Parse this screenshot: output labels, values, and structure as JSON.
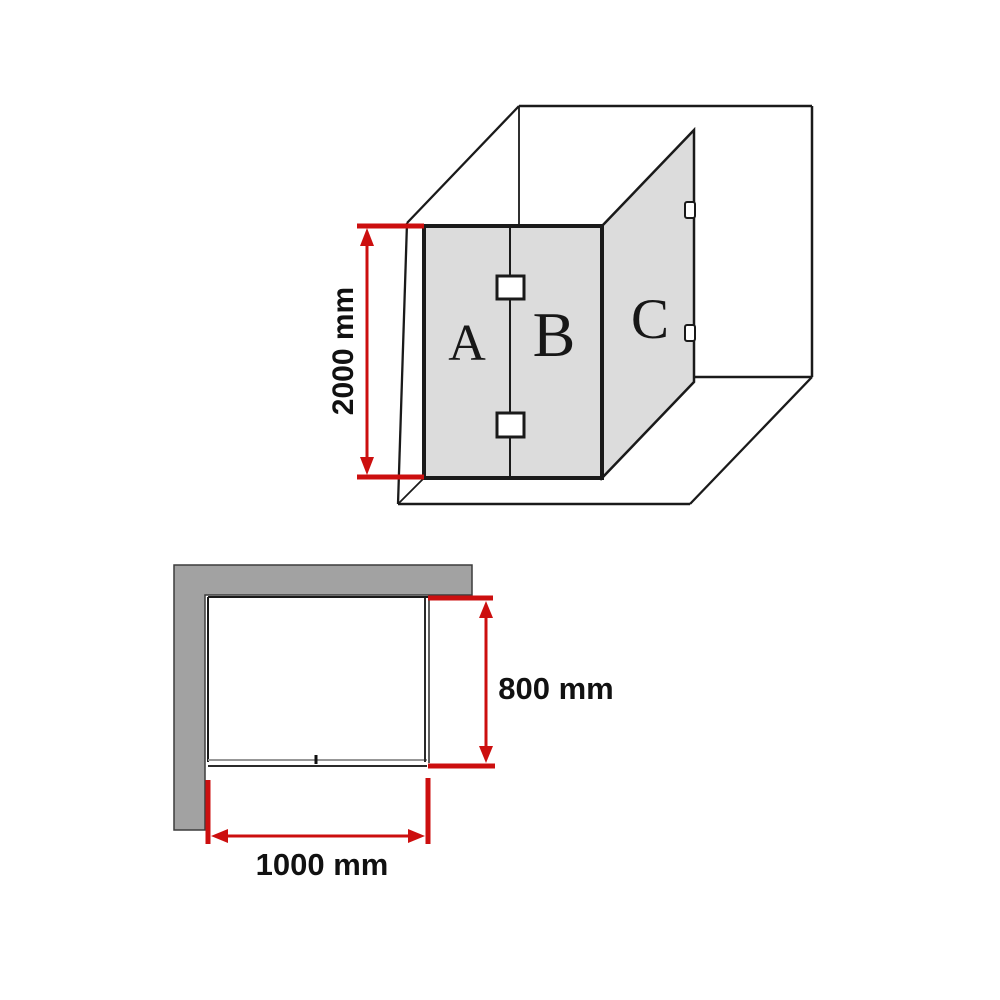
{
  "colors": {
    "dimension_red": "#cc0f0f",
    "glass_gray": "#dcdcdc",
    "wall_gray": "#a2a2a2",
    "line_black": "#1a1a1a"
  },
  "perspective_view": {
    "panel_a_label": "A",
    "panel_b_label": "B",
    "panel_c_label": "C",
    "height_dimension": "2000 mm"
  },
  "plan_view": {
    "depth_dimension": "800 mm",
    "width_dimension": "1000 mm"
  }
}
